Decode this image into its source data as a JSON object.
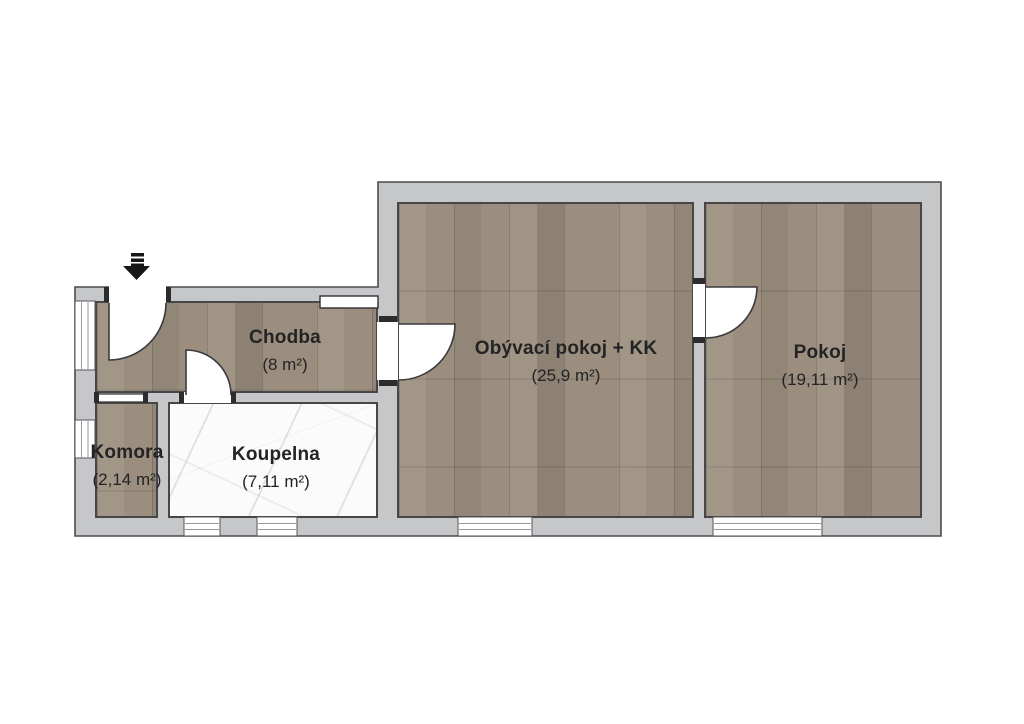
{
  "floorplan": {
    "rooms": [
      {
        "id": "chodba",
        "name": "Chodba",
        "area": "(8 m²)"
      },
      {
        "id": "komora",
        "name": "Komora",
        "area": "(2,14 m²)"
      },
      {
        "id": "koupelna",
        "name": "Koupelna",
        "area": "(7,11 m²)"
      },
      {
        "id": "obyvaci",
        "name": "Obývací pokoj + KK",
        "area": "(25,9 m²)"
      },
      {
        "id": "pokoj",
        "name": "Pokoj",
        "area": "(19,11 m²)"
      }
    ],
    "entrance": {
      "icon": "down-arrow-icon",
      "direction": "down"
    },
    "colors": {
      "wall": "#c6c7c9",
      "outline": "#47474a",
      "wood_floor": "#9b8e7e",
      "marble_floor": "#fbfbfc",
      "label_text": "#232325",
      "background": "#ffffff"
    }
  }
}
